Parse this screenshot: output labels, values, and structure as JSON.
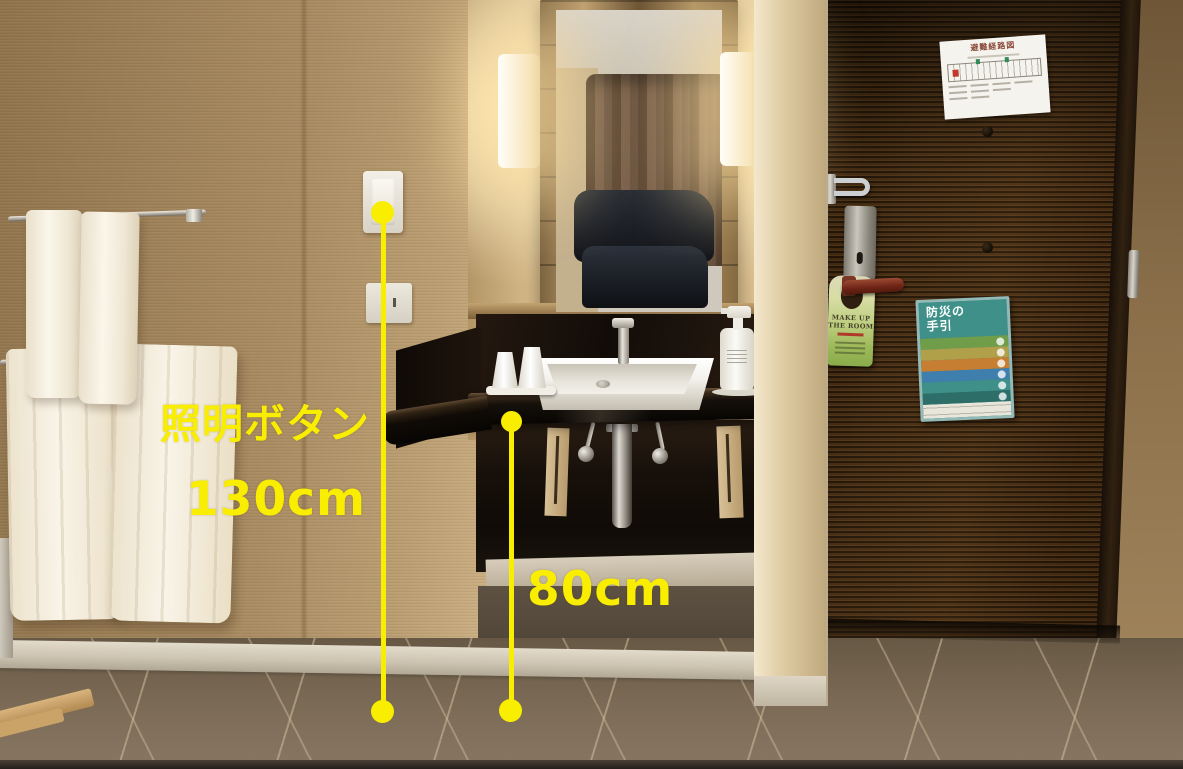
{
  "scene": {
    "type": "photograph",
    "subject": "Hotel accessible room entrance with vanity counter, towels and door, annotated with fixture heights"
  },
  "annotations": {
    "color": "#f9ee00",
    "switch_label": "照明ボタン",
    "switch_height": "130cm",
    "counter_height": "80cm"
  },
  "door_signs": {
    "evacuation_map_title": "避難経路図",
    "door_hanger_title_line1": "MAKE UP",
    "door_hanger_title_line2": "THE ROOM",
    "poster_title_line1": "防災の",
    "poster_title_line2": "手引",
    "poster_header_color": "#3f9089",
    "poster_stripes": [
      "#6f9d4a",
      "#b0a04a",
      "#c67e33",
      "#3f7fae",
      "#3f9089",
      "#2e6e68"
    ]
  }
}
